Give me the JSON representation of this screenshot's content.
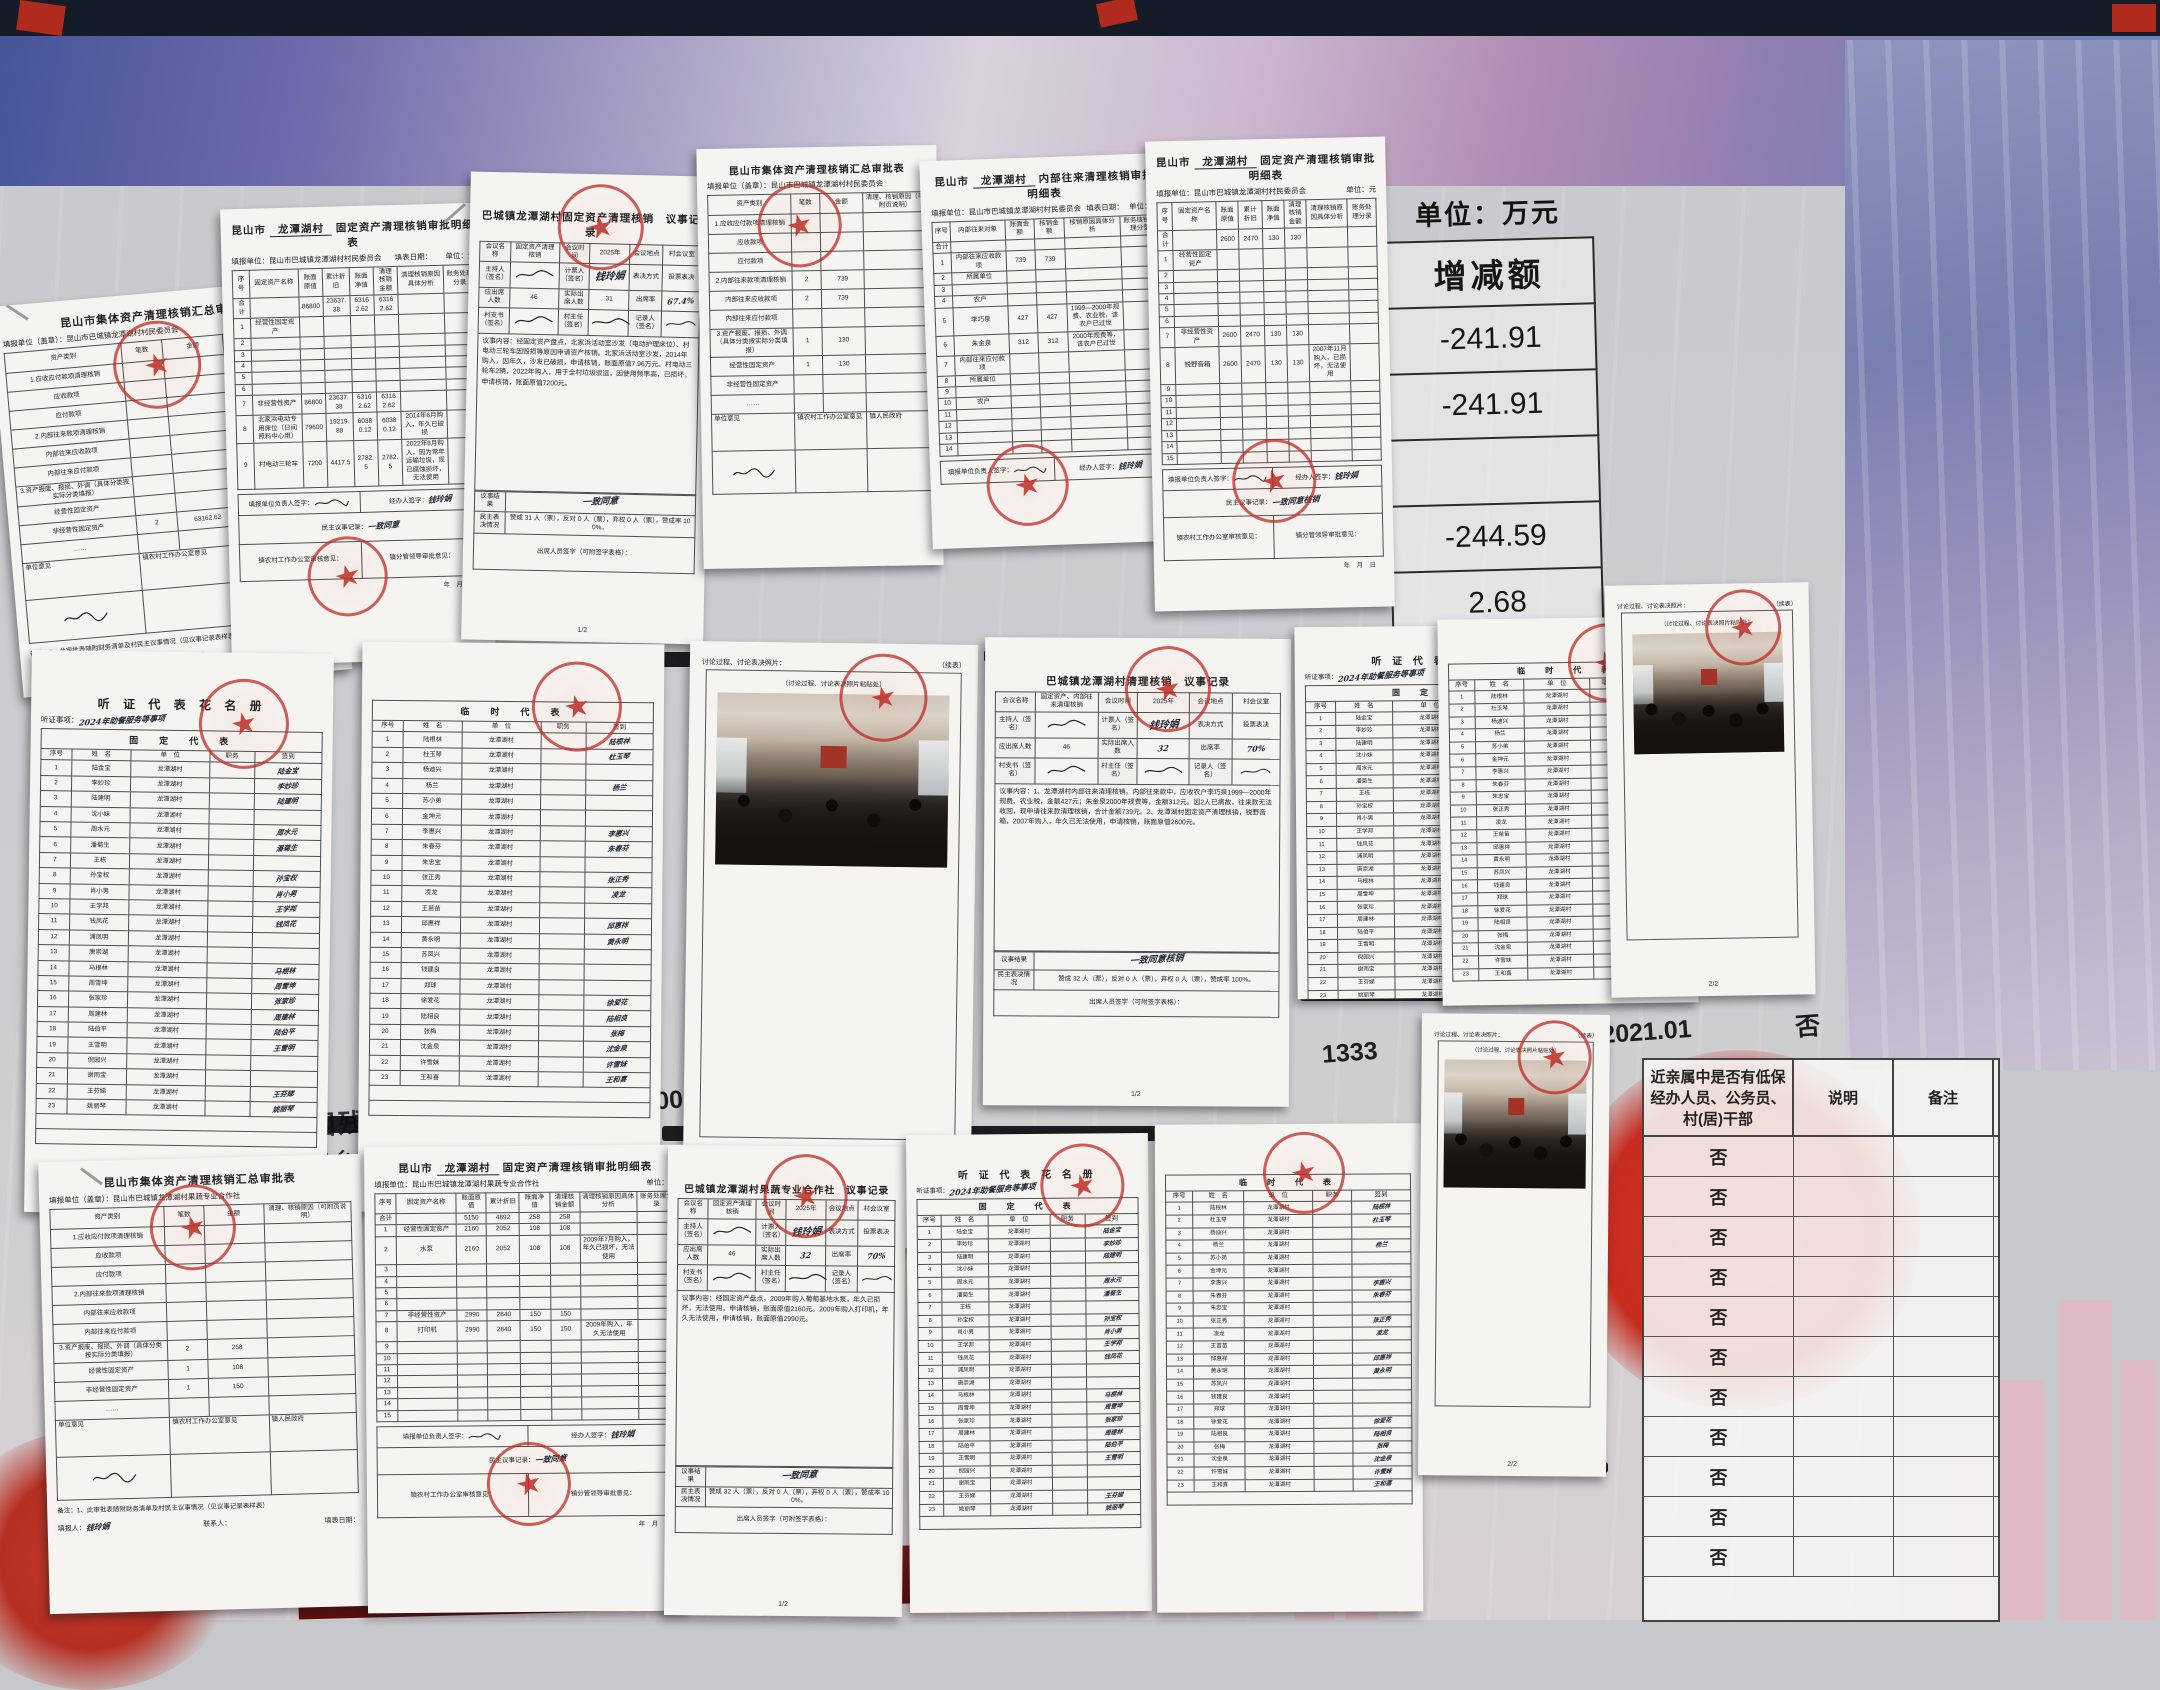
{
  "board": {
    "unit_label": "单位：万元",
    "change_header": "增减额",
    "change_values": [
      "-241.91",
      "-241.91",
      "",
      "-244.59",
      "2.68",
      "",
      "581.05"
    ],
    "strip": [
      "225000",
      "95000",
      "140000",
      "85000",
      "王财喜",
      "1",
      "1333",
      "1667",
      "2021.01",
      "否"
    ],
    "fragment_subtotal": "一、贫困残疾小计",
    "fragment_city": "昆山市城乡特困生活保障",
    "band_text": "镇人优质果蔬种植园",
    "relative_header": "近亲属中是否有低保经办人员、公务员、村(居)干部",
    "relative_col2": "说明",
    "relative_col3": "备注",
    "relative_rows": [
      "否",
      "否",
      "否",
      "否",
      "否",
      "否",
      "否",
      "否",
      "否",
      "否",
      "否"
    ]
  },
  "labels": {
    "summary_title": "昆山市集体资产清理核销汇总审批表",
    "det_prefix": "昆山市",
    "village": "龙潭湖村",
    "det_suffix": "固定资产清理核销审批明细表",
    "int_suffix": "内部往来清理核销审批明细表",
    "org_v_seal": "填报单位（盖章）：昆山市巴城镇龙潭湖村村民委员会",
    "org_v": "填报单位：昆山市巴城镇龙潭湖村村民委员会",
    "org_c_seal": "填报单位（盖章）：昆山市巴城镇龙潭湖村果蔬专业合作社",
    "org_c": "填报单位：昆山市巴城镇龙潭湖村果蔬专业合作社",
    "fill_date": "填表日期：",
    "unit_yuan": "单位：元",
    "sum_cols": [
      "资产类别",
      "笔数",
      "金额",
      "清理、核销原因（可附页说明）"
    ],
    "det_cols": [
      "序号",
      "固定资产名称",
      "账面原值",
      "累计折旧",
      "账面净值",
      "清理核销金额",
      "清理核销原因具体分析",
      "账务处理分录"
    ],
    "int_cols": [
      "序号",
      "内部往来对象",
      "账面金额",
      "核销金额",
      "核销原因具体分析",
      "账务核销处理分录"
    ],
    "opinion_unit": "单位意见",
    "opinion_town": "镇农村工作办公室意见",
    "opinion_gov": "镇人民政府",
    "note": "备注：1、此审批表随附财务清单及村民主议事情况（见议事记录表样表）",
    "filler": "填报人：",
    "contact": "联系人：",
    "date2": "填表日期：",
    "leader_sign": "填报单位负责人签字：",
    "handler_sign": "经办人签字：",
    "democratic": "民主议事记录：",
    "town_check": "镇农村工作办公室审核意见：",
    "town_leader": "镇分管领导审批意见：",
    "ymd": "年　月　日",
    "meeting_name": "会议名称",
    "meeting_time": "会议时间",
    "meeting_place": "会议地点",
    "host": "主持人（签名）",
    "teller": "计票人（签名）",
    "vote_method": "表决方式",
    "ballot": "投票表决",
    "should": "应出席人数",
    "actual": "实际出席人数",
    "rate": "出席率",
    "secretary": "村支书（签名）",
    "director": "村主任（签名）",
    "recorder": "记录人（签名）",
    "content_label": "议事内容：",
    "result_label": "议事结果",
    "vote_label": "民主表决情况",
    "attendee_sign": "出席人员签字（可附签字表格）：",
    "hearing_title": "听 证 代 表 花 名 册",
    "hearing_item": "听证事项：",
    "hearing_item_value": "2024年助餐服务等事项",
    "fixed_header": "固　定　代　表",
    "temp_header": "临　时　代　表",
    "roster_cols": [
      "序号",
      "姓　名",
      "单　位",
      "职务",
      "签到"
    ],
    "photo_head": "讨论过程、讨论表决照片：",
    "cont_mark": "（续表）",
    "photo_paste": "（讨论过程、讨论表决照片粘贴处）",
    "page12": "1/2",
    "page22": "2/2",
    "teller_name": "钱玲娟",
    "place_value": "村会议室",
    "seal_text": "昆山市巴城镇龙潭湖村村民委员会"
  },
  "meetings": {
    "m1": {
      "title": "巴城镇龙潭湖村固定资产清理核销　议事记录",
      "name": "固定资产清理核销",
      "time": "2025年",
      "should": "46",
      "actual": "31",
      "rate": "67.4%",
      "content": "经固定资产盘点，北家浜活动室沙发（电动护理床位）、村电动三轮车因毁损等原因申请资产核销。北家浜活动室沙发，2014年购入，因年久，沙发已破损，申请核销，账面原值7.96万元。村电动三轮车2辆，2022年购入，用于全村垃圾驳运，因使用频率高，已损坏，申请核销，账面原值7200元。",
      "result": "一致同意",
      "vote": "赞成 31 人（票），反对 0 人（票），弃权 0 人（票），赞成率 100%。"
    },
    "m2": {
      "title": "巴城镇龙潭湖村清理核销　议事记录",
      "name": "固定资产、内部往来清理核销",
      "time": "2025年",
      "should": "46",
      "actual": "32",
      "rate": "70%",
      "content": "1、龙潭湖村内部往来清理核销。内部往来款中，应收农户李巧泉1999—2000年规费、农业税，金额427元；朱金泉2000年规费等，金额312元。因2人已病故，往来款无法收回，现申请往来款清理核销，合计金额739元。2、龙潭湖村固定资产清理核销，锐野音箱，2007年购入，年久已无法使用，申请核销，账面原值2600元。",
      "result": "一致同意核销",
      "vote": "赞成 32 人（票），反对 0 人（票），弃权 0 人（票），赞成率 100%。"
    },
    "m3": {
      "title": "巴城镇龙潭湖村果蔬专业合作社　议事记录",
      "name": "固定资产清理核销",
      "time": "2025年",
      "should": "46",
      "actual": "32",
      "rate": "70%",
      "content": "经固定资产盘点，2009年购入葡萄基地水泵，年久已损坏，无法使用，申请核销，账面原值2160元。2009年购入打印机，年久无法使用，申请核销，账面原值2990元。",
      "result": "一致同意",
      "vote": "赞成 32 人（票），反对 0 人（票），弃权 0 人（票），赞成率 100%。"
    }
  },
  "sum1": {
    "rows": [
      [
        "1.应收应付款项清理核销",
        "",
        "",
        ""
      ],
      [
        "应收款项",
        "",
        "",
        ""
      ],
      [
        "应付款项",
        "",
        "",
        ""
      ],
      [
        "2.内部往来款项清理核销",
        "",
        "",
        ""
      ],
      [
        "内部往来应收款项",
        "",
        "",
        ""
      ],
      [
        "内部往来应付款项",
        "",
        "",
        ""
      ],
      [
        "3.资产报废、报损、外调（具体分类按实际分类填报）",
        "",
        "",
        ""
      ],
      [
        "经营性固定资产",
        "",
        "",
        ""
      ],
      [
        "非经营性固定资产",
        "2",
        "63162.62",
        ""
      ],
      [
        "……",
        "",
        "",
        ""
      ]
    ]
  },
  "sum2": {
    "rows": [
      [
        "1.应收应付款项清理核销",
        "",
        "",
        ""
      ],
      [
        "应收款项",
        "",
        "",
        ""
      ],
      [
        "应付款项",
        "",
        "",
        ""
      ],
      [
        "2.内部往来款项清理核销",
        "2",
        "739",
        ""
      ],
      [
        "内部往来应收款项",
        "2",
        "739",
        ""
      ],
      [
        "内部往来应付款项",
        "",
        "",
        ""
      ],
      [
        "3.资产报废、报损、外调（具体分类按实际分类填报）",
        "1",
        "130",
        ""
      ],
      [
        "经营性固定资产",
        "1",
        "130",
        ""
      ],
      [
        "非经营性固定资产",
        "",
        "",
        ""
      ],
      [
        "……",
        "",
        "",
        ""
      ]
    ]
  },
  "sum3": {
    "rows": [
      [
        "1.应收应付款项清理核销",
        "",
        "",
        ""
      ],
      [
        "应收款项",
        "",
        "",
        ""
      ],
      [
        "应付款项",
        "",
        "",
        ""
      ],
      [
        "2.内部往来款项清理核销",
        "",
        "",
        ""
      ],
      [
        "内部往来应收款项",
        "",
        "",
        ""
      ],
      [
        "内部往来应付款项",
        "",
        "",
        ""
      ],
      [
        "3.资产报废、报损、外调（具体分类按实际分类填报）",
        "2",
        "258",
        ""
      ],
      [
        "经营性固定资产",
        "1",
        "108",
        ""
      ],
      [
        "非经营性固定资产",
        "1",
        "150",
        ""
      ],
      [
        "……",
        "",
        "",
        ""
      ]
    ]
  },
  "det1": {
    "rows": [
      [
        "合计",
        "",
        "86800",
        "23637.38",
        "63162.62",
        "63162.62",
        "",
        ""
      ],
      [
        "1",
        "经营性固定资产",
        "",
        "",
        "",
        "",
        "",
        ""
      ],
      [
        "2",
        "",
        "",
        "",
        "",
        "",
        "",
        ""
      ],
      [
        "3",
        "",
        "",
        "",
        "",
        "",
        "",
        ""
      ],
      [
        "4",
        "",
        "",
        "",
        "",
        "",
        "",
        ""
      ],
      [
        "5",
        "",
        "",
        "",
        "",
        "",
        "",
        ""
      ],
      [
        "6",
        "",
        "",
        "",
        "",
        "",
        "",
        ""
      ],
      [
        "7",
        "非经营性资产",
        "86800",
        "23637.38",
        "63162.62",
        "63162.62",
        "",
        ""
      ],
      [
        "8",
        "北家浜电动专用床位（日间照料中心用）",
        "79600",
        "19219.88",
        "60380.12",
        "60380.12",
        "2014年6月购入，年久已破损",
        ""
      ],
      [
        "9",
        "村电动三轮车",
        "7200",
        "4417.5",
        "2782.5",
        "2782.5",
        "2022年8月购入，因为常年运输垃圾，现已腐蚀损坏，无法使用",
        ""
      ]
    ]
  },
  "det2": {
    "rows": [
      [
        "合计",
        "",
        "2600",
        "2470",
        "130",
        "130",
        "",
        ""
      ],
      [
        "1",
        "经营性固定资产",
        "",
        "",
        "",
        "",
        "",
        ""
      ],
      [
        "2",
        "",
        "",
        "",
        "",
        "",
        "",
        ""
      ],
      [
        "3",
        "",
        "",
        "",
        "",
        "",
        "",
        ""
      ],
      [
        "4",
        "",
        "",
        "",
        "",
        "",
        "",
        ""
      ],
      [
        "5",
        "",
        "",
        "",
        "",
        "",
        "",
        ""
      ],
      [
        "6",
        "",
        "",
        "",
        "",
        "",
        "",
        ""
      ],
      [
        "7",
        "非经营性资产",
        "2600",
        "2470",
        "130",
        "130",
        "",
        ""
      ],
      [
        "8",
        "锐野音箱",
        "2600",
        "2470",
        "130",
        "130",
        "2007年11月购入，已损坏，无法使用",
        ""
      ],
      [
        "9",
        "",
        "",
        "",
        "",
        "",
        "",
        ""
      ],
      [
        "10",
        "",
        "",
        "",
        "",
        "",
        "",
        ""
      ],
      [
        "11",
        "",
        "",
        "",
        "",
        "",
        "",
        ""
      ],
      [
        "12",
        "",
        "",
        "",
        "",
        "",
        "",
        ""
      ],
      [
        "13",
        "",
        "",
        "",
        "",
        "",
        "",
        ""
      ],
      [
        "14",
        "",
        "",
        "",
        "",
        "",
        "",
        ""
      ],
      [
        "15",
        "",
        "",
        "",
        "",
        "",
        "",
        ""
      ]
    ]
  },
  "det3": {
    "rows": [
      [
        "合计",
        "",
        "5150",
        "4892",
        "258",
        "258",
        "",
        ""
      ],
      [
        "1",
        "经营性固定资产",
        "2160",
        "2052",
        "108",
        "108",
        "",
        ""
      ],
      [
        "2",
        "水泵",
        "2160",
        "2052",
        "108",
        "108",
        "2009年7月购入，年久已损坏，无法使用",
        ""
      ],
      [
        "3",
        "",
        "",
        "",
        "",
        "",
        "",
        ""
      ],
      [
        "4",
        "",
        "",
        "",
        "",
        "",
        "",
        ""
      ],
      [
        "5",
        "",
        "",
        "",
        "",
        "",
        "",
        ""
      ],
      [
        "6",
        "",
        "",
        "",
        "",
        "",
        "",
        ""
      ],
      [
        "7",
        "非经营性资产",
        "2990",
        "2840",
        "150",
        "150",
        "",
        ""
      ],
      [
        "8",
        "打印机",
        "2990",
        "2840",
        "150",
        "150",
        "2009年购入，年久无法使用",
        ""
      ],
      [
        "9",
        "",
        "",
        "",
        "",
        "",
        "",
        ""
      ],
      [
        "10",
        "",
        "",
        "",
        "",
        "",
        "",
        ""
      ],
      [
        "11",
        "",
        "",
        "",
        "",
        "",
        "",
        ""
      ],
      [
        "12",
        "",
        "",
        "",
        "",
        "",
        "",
        ""
      ],
      [
        "13",
        "",
        "",
        "",
        "",
        "",
        "",
        ""
      ],
      [
        "14",
        "",
        "",
        "",
        "",
        "",
        "",
        ""
      ],
      [
        "15",
        "",
        "",
        "",
        "",
        "",
        "",
        ""
      ]
    ]
  },
  "internal": {
    "rows": [
      [
        "合计",
        "",
        "",
        "",
        "",
        ""
      ],
      [
        "1",
        "内部往来应收款项",
        "739",
        "739",
        "",
        ""
      ],
      [
        "2",
        "所属单位",
        "",
        "",
        "",
        ""
      ],
      [
        "3",
        "",
        "",
        "",
        "",
        ""
      ],
      [
        "4",
        "农户",
        "",
        "",
        "",
        ""
      ],
      [
        "5",
        "李巧泉",
        "427",
        "427",
        "1999—2000年规费、农业税，该农户已过世",
        ""
      ],
      [
        "6",
        "朱金泉",
        "312",
        "312",
        "2000年规费等，该农户已过世",
        ""
      ],
      [
        "7",
        "内部往来应付款项",
        "",
        "",
        "",
        ""
      ],
      [
        "8",
        "所属单位",
        "",
        "",
        "",
        ""
      ],
      [
        "9",
        "",
        "",
        "",
        "",
        ""
      ],
      [
        "10",
        "农户",
        "",
        "",
        "",
        ""
      ],
      [
        "11",
        "",
        "",
        "",
        "",
        ""
      ],
      [
        "12",
        "",
        "",
        "",
        "",
        ""
      ],
      [
        "13",
        "",
        "",
        "",
        "",
        ""
      ],
      [
        "14",
        "",
        "",
        "",
        "",
        ""
      ]
    ]
  },
  "rosters": {
    "fixed": [
      [
        "陆金宝",
        "龙潭湖村",
        "陆金宝"
      ],
      [
        "李妙珍",
        "龙潭湖村",
        "李妙珍"
      ],
      [
        "陆建明",
        "龙潭湖村",
        "陆建明"
      ],
      [
        "沈小妹",
        "龙潭湖村",
        ""
      ],
      [
        "周水元",
        "龙潭湖村",
        "周水元"
      ],
      [
        "潘菊生",
        "龙潭湖村",
        "潘菊生"
      ],
      [
        "王栋",
        "龙潭湖村",
        ""
      ],
      [
        "孙宝权",
        "龙潭湖村",
        "孙宝权"
      ],
      [
        "肖小男",
        "龙潭湖村",
        "肖小男"
      ],
      [
        "王学邦",
        "龙潭湖村",
        "王学邦"
      ],
      [
        "钱凤花",
        "龙潭湖村",
        "钱凤花"
      ],
      [
        "浦凤明",
        "龙潭湖村",
        ""
      ],
      [
        "唐崇湖",
        "龙潭湖村",
        ""
      ],
      [
        "马根林",
        "龙潭湖村",
        "马根林"
      ],
      [
        "周雪坤",
        "龙潭湖村",
        "周雪坤"
      ],
      [
        "张家珍",
        "龙潭湖村",
        "张家珍"
      ],
      [
        "周建林",
        "龙潭湖村",
        "周建林"
      ],
      [
        "陆伯平",
        "龙潭湖村",
        "陆伯平"
      ],
      [
        "王雪明",
        "龙潭湖村",
        "王雪明"
      ],
      [
        "倪园兴",
        "龙潭湖村",
        ""
      ],
      [
        "谢雨宝",
        "龙潭湖村",
        ""
      ],
      [
        "王芬娣",
        "龙潭湖村",
        "王芬娣"
      ],
      [
        "姚丽琴",
        "龙潭湖村",
        "姚丽琴"
      ]
    ],
    "temp": [
      [
        "陆根林",
        "龙潭湖村",
        "陆根林"
      ],
      [
        "杜玉琴",
        "龙潭湖村",
        "杜玉琴"
      ],
      [
        "杨迪兴",
        "龙潭湖村",
        ""
      ],
      [
        "杨兰",
        "龙潭湖村",
        "杨兰"
      ],
      [
        "苏小弟",
        "龙潭湖村",
        ""
      ],
      [
        "金坤元",
        "龙潭湖村",
        ""
      ],
      [
        "李惠兴",
        "龙潭湖村",
        "李惠兴"
      ],
      [
        "朱春芬",
        "龙潭湖村",
        "朱春芬"
      ],
      [
        "朱忠宝",
        "龙潭湖村",
        ""
      ],
      [
        "张正秀",
        "龙潭湖村",
        "张正秀"
      ],
      [
        "凌龙",
        "龙潭湖村",
        "凌龙"
      ],
      [
        "王苗苗",
        "龙潭湖村",
        ""
      ],
      [
        "邱惠祥",
        "龙潭湖村",
        "邱惠祥"
      ],
      [
        "黄永明",
        "龙潭湖村",
        "黄永明"
      ],
      [
        "苏凤兴",
        "龙潭湖村",
        ""
      ],
      [
        "钱建良",
        "龙潭湖村",
        ""
      ],
      [
        "郑球",
        "龙潭湖村",
        ""
      ],
      [
        "徐爱花",
        "龙潭湖村",
        "徐爱花"
      ],
      [
        "陆相良",
        "龙潭湖村",
        "陆相良"
      ],
      [
        "张梅",
        "龙潭湖村",
        "张梅"
      ],
      [
        "沈金泉",
        "龙潭湖村",
        "沈金泉"
      ],
      [
        "许雪妹",
        "龙潭湖村",
        "许雪妹"
      ],
      [
        "王和喜",
        "龙潭湖村",
        "王和喜"
      ]
    ]
  }
}
